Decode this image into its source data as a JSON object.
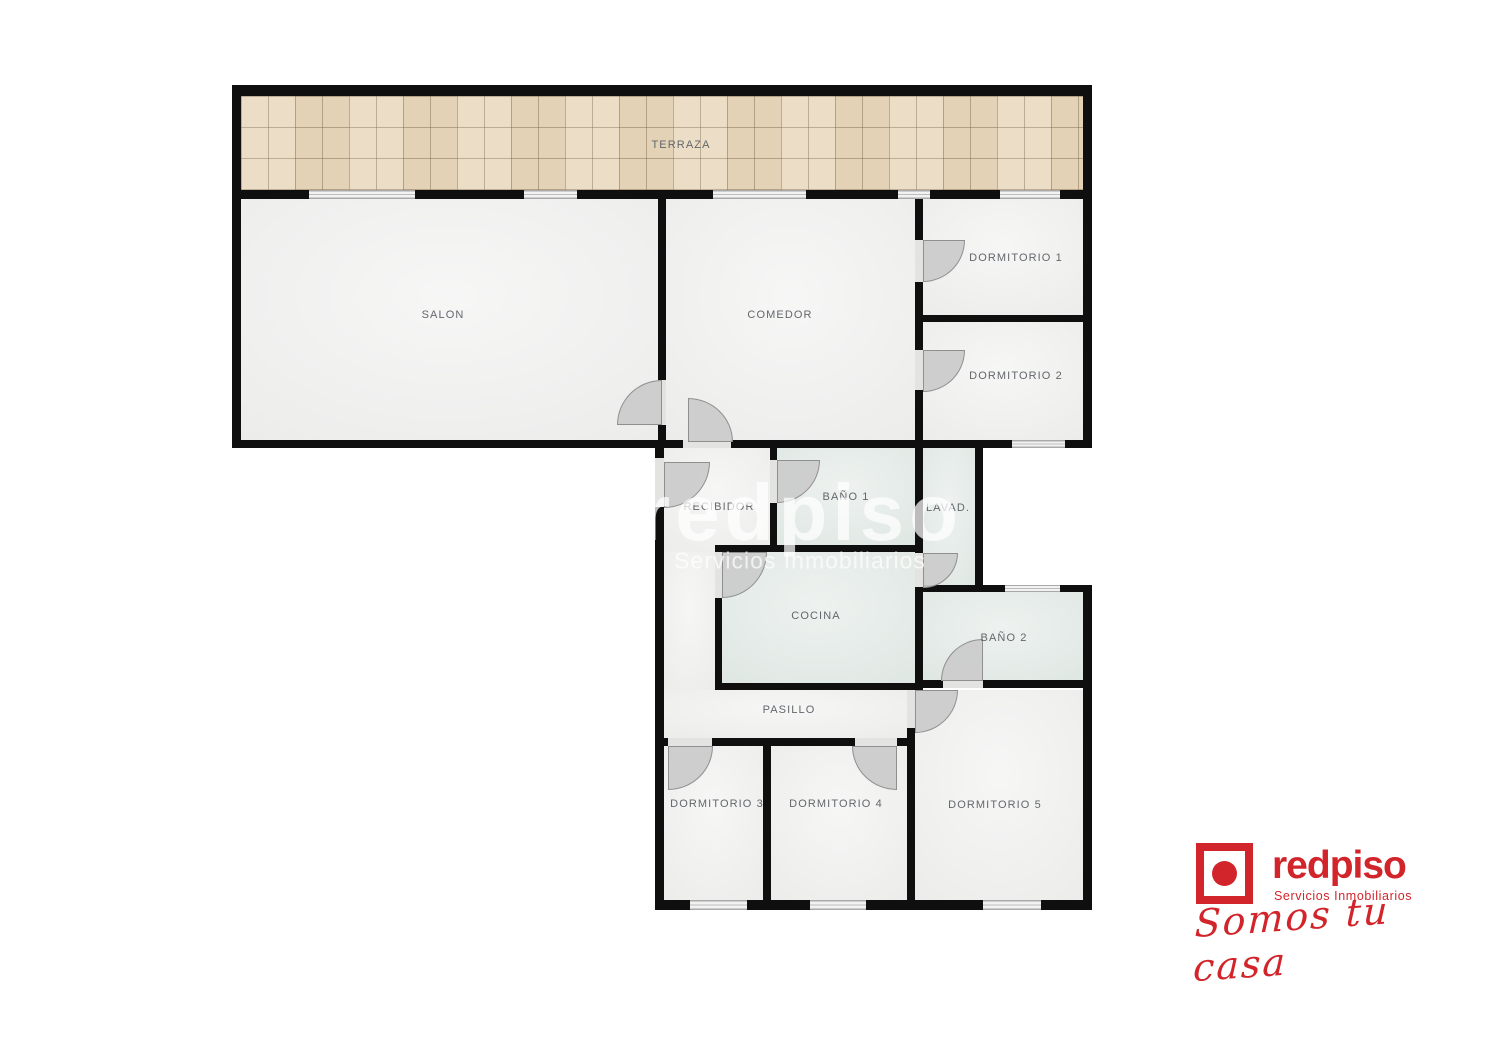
{
  "title": "Plano de vivienda - redpiso",
  "rooms": {
    "terraza": {
      "label": "TERRAZA"
    },
    "salon": {
      "label": "SALON"
    },
    "comedor": {
      "label": "COMEDOR"
    },
    "dormitorio1": {
      "label": "DORMITORIO 1"
    },
    "dormitorio2": {
      "label": "DORMITORIO 2"
    },
    "recibidor": {
      "label": "RECIBIDOR"
    },
    "bano1": {
      "label": "BAÑO 1"
    },
    "lavadero": {
      "label": "LAVAD."
    },
    "cocina": {
      "label": "COCINA"
    },
    "bano2": {
      "label": "BAÑO 2"
    },
    "pasillo": {
      "label": "PASILLO"
    },
    "dormitorio3": {
      "label": "DORMITORIO 3"
    },
    "dormitorio4": {
      "label": "DORMITORIO 4"
    },
    "dormitorio5": {
      "label": "DORMITORIO 5"
    }
  },
  "watermark": {
    "brand": "redpiso",
    "subtitle": "Servicios Inmobiliarios"
  },
  "logo": {
    "brand": "redpiso",
    "subtitle": "Servicios Inmobiliarios",
    "tagline": "Somos tu casa"
  },
  "colors": {
    "accent_red": "#d2252b",
    "wall": "#0f0f0f",
    "tile_beige": "#e9d9c0",
    "wet_room_green": "#dfe7e3",
    "room_grey": "#ececeb"
  }
}
